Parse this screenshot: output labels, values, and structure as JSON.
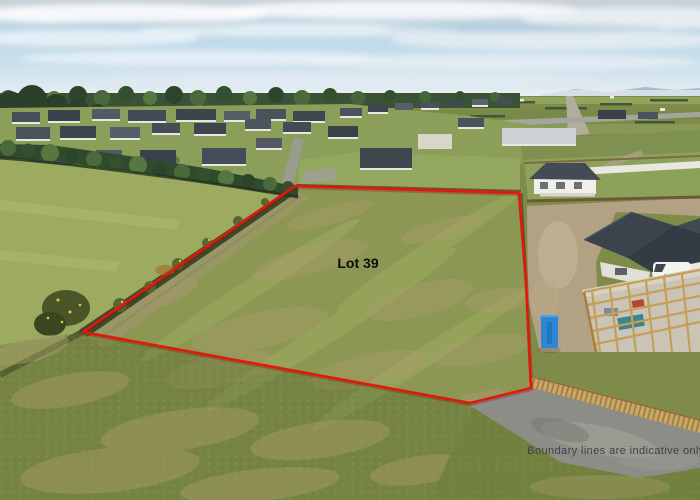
{
  "scene": {
    "description": "Aerial drone photograph of a vacant residential section for sale, outlined in red",
    "lot_label": "Lot 39",
    "disclaimer": "Boundary lines are indicative only"
  },
  "boundary": {
    "color": "#e3170a",
    "shadow_color": "#8a0e04",
    "stroke_width": 2.6,
    "closed": true,
    "points": [
      [
        295,
        186
      ],
      [
        519,
        193
      ],
      [
        526,
        282
      ],
      [
        531,
        388
      ],
      [
        470,
        403
      ],
      [
        83,
        332
      ]
    ]
  },
  "colors": {
    "sky_top": "#c8d1d6",
    "sky_blue": "#bcd7e7",
    "sky_low": "#e7eef2",
    "grass_base": "#7f8c49",
    "lot_grass": "#8e9854",
    "pasture_grass": "#9cab60",
    "hedge_green": "#2f4a2d",
    "road_gray": "#8d8d88",
    "timber_fence": "#c9a766",
    "roof_charcoal": "#3b434c",
    "portaloo_blue": "#2f86d6",
    "lot_label_color": "#0d0d0d",
    "disclaimer_color": "#3d4247"
  },
  "houses": [
    {
      "x": 340,
      "y": 108,
      "w": 22,
      "h": 8,
      "roof": "#4a525b",
      "wall": true
    },
    {
      "x": 368,
      "y": 105,
      "w": 20,
      "h": 7,
      "roof": "#3d454e",
      "wall": true
    },
    {
      "x": 395,
      "y": 103,
      "w": 18,
      "h": 7,
      "roof": "#565e66",
      "wall": false
    },
    {
      "x": 421,
      "y": 102,
      "w": 18,
      "h": 6,
      "roof": "#49525a",
      "wall": true
    },
    {
      "x": 447,
      "y": 100,
      "w": 16,
      "h": 6,
      "roof": "#3f474f",
      "wall": false
    },
    {
      "x": 472,
      "y": 99,
      "w": 16,
      "h": 6,
      "roof": "#59616a",
      "wall": true
    },
    {
      "x": 497,
      "y": 98,
      "w": 15,
      "h": 6,
      "roof": "#454d55",
      "wall": false
    },
    {
      "x": 12,
      "y": 112,
      "w": 28,
      "h": 10,
      "roof": "#47505a",
      "wall": true
    },
    {
      "x": 48,
      "y": 110,
      "w": 32,
      "h": 11,
      "roof": "#3a434c",
      "wall": true
    },
    {
      "x": 92,
      "y": 109,
      "w": 28,
      "h": 10,
      "roof": "#525a64",
      "wall": true
    },
    {
      "x": 128,
      "y": 110,
      "w": 38,
      "h": 11,
      "roof": "#434b55",
      "wall": true
    },
    {
      "x": 176,
      "y": 109,
      "w": 40,
      "h": 11,
      "roof": "#3c444e",
      "wall": true
    },
    {
      "x": 224,
      "y": 111,
      "w": 26,
      "h": 9,
      "roof": "#555d67",
      "wall": true
    },
    {
      "x": 256,
      "y": 109,
      "w": 30,
      "h": 10,
      "roof": "#49515b",
      "wall": true
    },
    {
      "x": 293,
      "y": 111,
      "w": 32,
      "h": 10,
      "roof": "#3e464f",
      "wall": true
    },
    {
      "x": 16,
      "y": 127,
      "w": 34,
      "h": 12,
      "roof": "#49525c",
      "wall": true
    },
    {
      "x": 60,
      "y": 126,
      "w": 36,
      "h": 12,
      "roof": "#3b434d",
      "wall": true
    },
    {
      "x": 110,
      "y": 127,
      "w": 30,
      "h": 11,
      "roof": "#565f68",
      "wall": true
    },
    {
      "x": 152,
      "y": 123,
      "w": 28,
      "h": 10,
      "roof": "#454d57",
      "wall": true
    },
    {
      "x": 194,
      "y": 123,
      "w": 32,
      "h": 11,
      "roof": "#3d454f",
      "wall": true
    },
    {
      "x": 245,
      "y": 119,
      "w": 26,
      "h": 10,
      "roof": "#4d555f",
      "wall": true
    },
    {
      "x": 283,
      "y": 122,
      "w": 28,
      "h": 10,
      "roof": "#434b54",
      "wall": true
    },
    {
      "x": 328,
      "y": 126,
      "w": 30,
      "h": 11,
      "roof": "#39414b",
      "wall": true
    },
    {
      "x": 28,
      "y": 148,
      "w": 46,
      "h": 17,
      "roof": "#49535d",
      "wall": true
    },
    {
      "x": 96,
      "y": 150,
      "w": 26,
      "h": 12,
      "roof": "#515a63",
      "wall": true
    },
    {
      "x": 140,
      "y": 150,
      "w": 36,
      "h": 14,
      "roof": "#39424b",
      "wall": false
    },
    {
      "x": 202,
      "y": 148,
      "w": 44,
      "h": 16,
      "roof": "#454e58",
      "wall": true
    },
    {
      "x": 256,
      "y": 138,
      "w": 26,
      "h": 10,
      "roof": "#515a63",
      "wall": true
    },
    {
      "x": 360,
      "y": 148,
      "w": 52,
      "h": 20,
      "roof": "#3e464e",
      "wall": true
    },
    {
      "x": 418,
      "y": 134,
      "w": 34,
      "h": 15,
      "roof": "#d9d5c9",
      "wall": false
    },
    {
      "x": 458,
      "y": 118,
      "w": 26,
      "h": 9,
      "roof": "#4a525a",
      "wall": true
    },
    {
      "x": 502,
      "y": 128,
      "w": 74,
      "h": 16,
      "roof": "#cdd1d4",
      "wall": true
    },
    {
      "x": 598,
      "y": 110,
      "w": 28,
      "h": 9,
      "roof": "#39414a",
      "wall": false
    },
    {
      "x": 638,
      "y": 112,
      "w": 20,
      "h": 7,
      "roof": "#4a525b",
      "wall": false
    }
  ]
}
